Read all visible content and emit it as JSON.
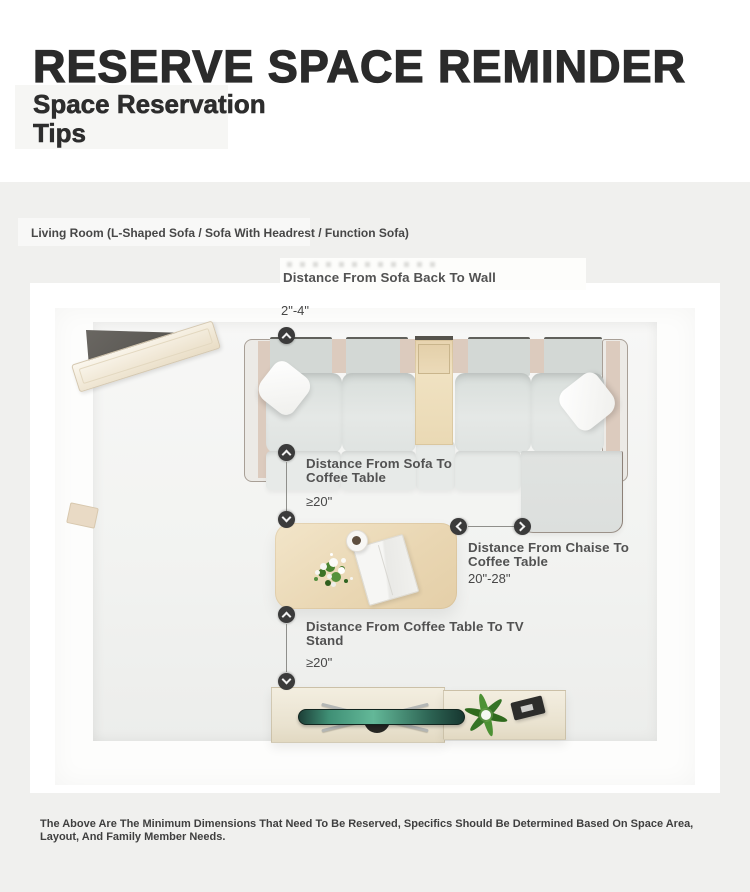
{
  "header": {
    "title": "RESERVE SPACE REMINDER",
    "subtitle_lines": [
      "Space Reservation",
      "Tips"
    ]
  },
  "section": {
    "room_label": "Living Room (L-Shaped Sofa / Sofa With Headrest / Function Sofa)"
  },
  "diagram": {
    "annotations": [
      {
        "id": "sofa-back-to-wall",
        "label": "Distance From Sofa Back To Wall",
        "value": "2\"-4\""
      },
      {
        "id": "sofa-to-coffee-table",
        "label": "Distance From Sofa To Coffee Table",
        "value": "≥20\""
      },
      {
        "id": "chaise-to-coffee-table",
        "label": "Distance From Chaise To Coffee Table",
        "value": "20\"-28\""
      },
      {
        "id": "coffee-table-to-tv-stand",
        "label": "Distance From Coffee Table To TV Stand",
        "value": "≥20\""
      }
    ],
    "furniture": [
      "corner-console",
      "l-shaped-sofa",
      "throw-pillows",
      "sofa-tray",
      "coffee-table",
      "flower-bouquet",
      "magazine",
      "coffee-cup",
      "tv-stand",
      "tv",
      "plant",
      "remote"
    ],
    "icons": [
      "chevron-up-icon",
      "chevron-down-icon",
      "chevron-left-icon",
      "chevron-right-icon"
    ]
  },
  "footer": {
    "note": "The Above Are The Minimum Dimensions That Need To Be Reserved, Specifics Should Be Determined Based On Space Area, Layout, And Family Member Needs."
  },
  "colors": {
    "section_bg": "#f0f0ee",
    "card_bg": "#ffffff",
    "annotation_circle": "#3b3b3b",
    "label_text": "#525252",
    "title_text": "#2b2b2b",
    "sofa_fabric": "#e2e6e4",
    "sofa_frame_beige": "#dccbbe",
    "wood_light": "#ecdcbc",
    "tv_screen_teal": "#3f8f75",
    "plant_green": "#3b7a27"
  }
}
